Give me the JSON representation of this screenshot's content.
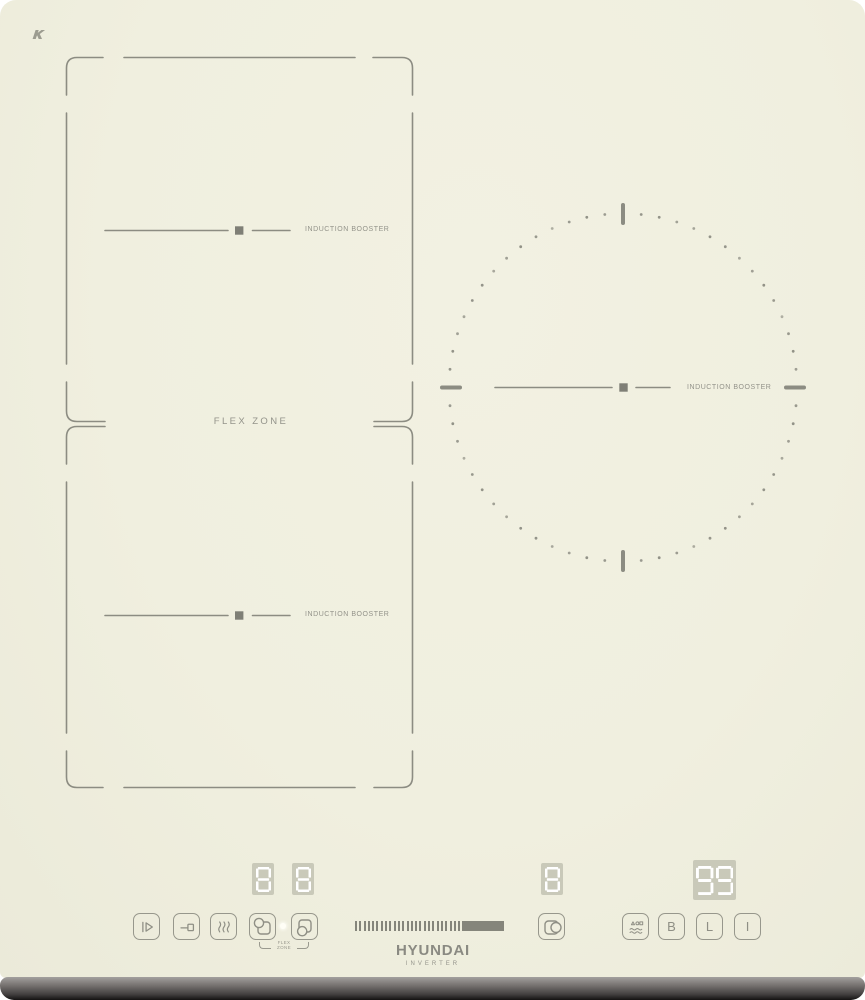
{
  "surface": {
    "glass_mark": "K",
    "flex_zone_label": "FLEX ZONE",
    "booster_label_upper": "INDUCTION BOOSTER",
    "booster_label_lower": "INDUCTION BOOSTER",
    "booster_label_right": "INDUCTION BOOSTER"
  },
  "displays": {
    "flex_upper_value": "8",
    "flex_lower_value": "8",
    "right_zone_value": "8",
    "timer_value": "99"
  },
  "controls": {
    "booster_label": "B",
    "lock_label": "L",
    "power_label": "I",
    "flex_bracket_line1": "FLEX",
    "flex_bracket_line2": "ZONE",
    "slider_tick_count": 25
  },
  "branding": {
    "brand": "HYUNDAI",
    "subline": "INVERTER"
  },
  "colors": {
    "surface": "#f0efdf",
    "line": "#8c8c82",
    "label": "#93938a",
    "display_bg": "#c9c9b9",
    "digit": "#ffffff",
    "slider_bar": "#85857b"
  },
  "decor": {
    "dot_ring": {
      "cx": 623,
      "cy": 387.5,
      "r": 174,
      "dots": 60,
      "skip_deg": 5
    }
  }
}
